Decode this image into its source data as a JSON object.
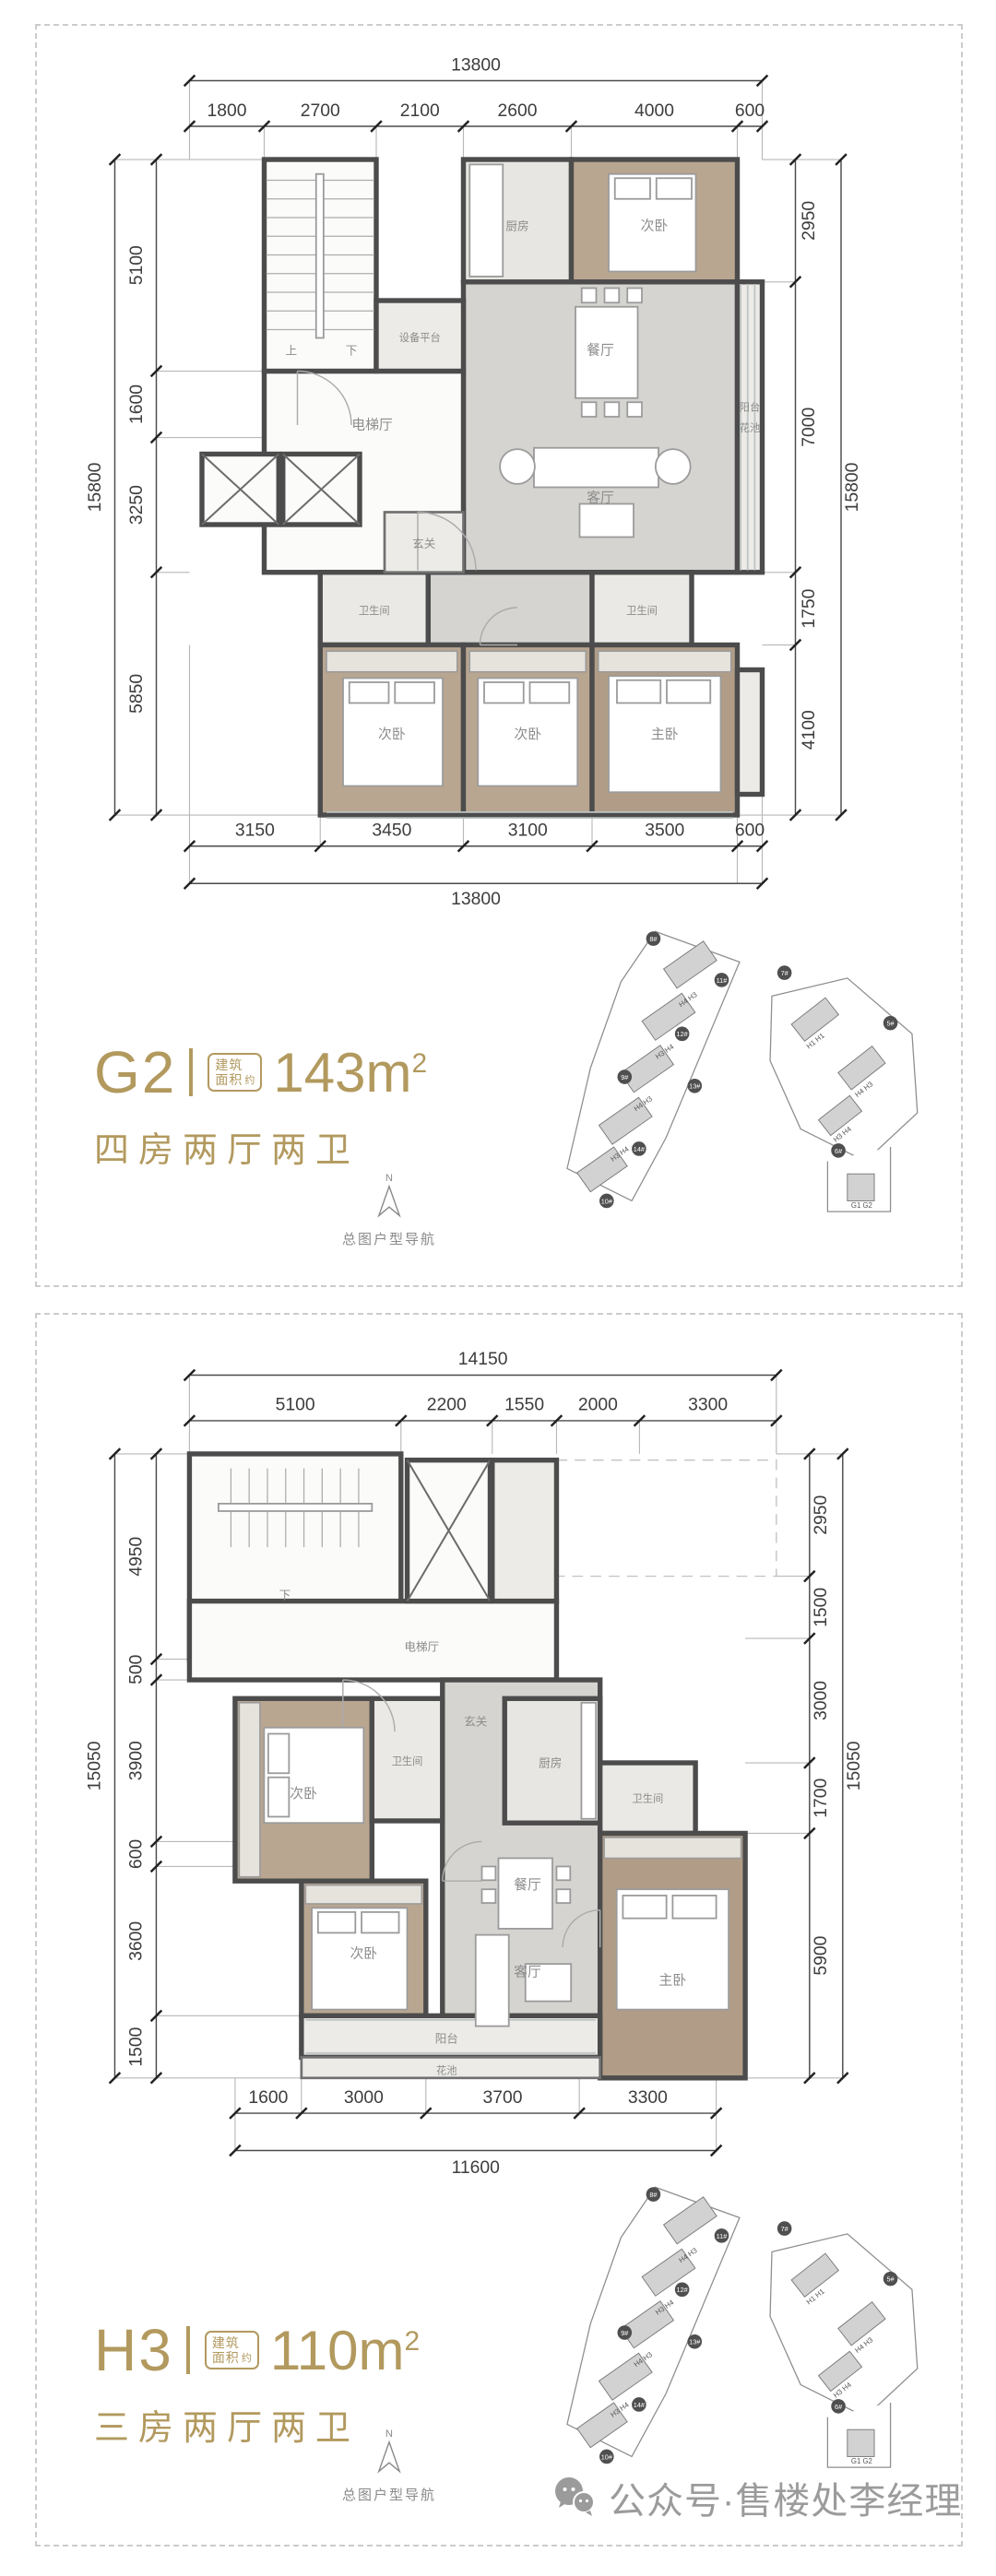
{
  "colors": {
    "gold": "#b2995e",
    "wall": "#4c4c4c",
    "wood": "#b9a691",
    "marble": "#d5d4d1",
    "watermark": "#9b9b9b"
  },
  "panels": [
    {
      "unit": {
        "code": "G2",
        "badge_line1": "建筑",
        "badge_line2": "面积",
        "badge_suffix": "约",
        "area": "143m",
        "area_sup": "2",
        "subtitle": "四房两厅两卫"
      },
      "plan": {
        "dims": {
          "top_total": "13800",
          "top_segments": [
            "1800",
            "2700",
            "2100",
            "2600",
            "4000",
            "600"
          ],
          "bottom_segments": [
            "3150",
            "3450",
            "3100",
            "3500",
            "600"
          ],
          "bottom_total": "13800",
          "left_segments": [
            "5100",
            "1600",
            "3250",
            "5850"
          ],
          "left_total": "15800",
          "right_segments": [
            "2950",
            "7000",
            "1750",
            "4100"
          ],
          "right_total": "15800"
        },
        "rooms": {
          "stair_up": "上",
          "stair_down": "下",
          "equipment": "设备平台",
          "kitchen": "厨房",
          "bedroom_top": "次卧",
          "dining": "餐厅",
          "living": "客厅",
          "balcony": "阳台",
          "flower_bed": "花池",
          "elevator_hall": "电梯厅",
          "foyer": "玄关",
          "bath_left": "卫生间",
          "bath_right": "卫生间",
          "bedroom_left": "次卧",
          "bedroom_mid": "次卧",
          "master": "主卧"
        }
      }
    },
    {
      "unit": {
        "code": "H3",
        "badge_line1": "建筑",
        "badge_line2": "面积",
        "badge_suffix": "约",
        "area": "110m",
        "area_sup": "2",
        "subtitle": "三房两厅两卫"
      },
      "plan": {
        "dims": {
          "top_total": "14150",
          "top_segments": [
            "5100",
            "2200",
            "1550",
            "2000",
            "3300"
          ],
          "bottom_segments": [
            "1600",
            "3000",
            "3700",
            "3300"
          ],
          "bottom_total": "11600",
          "left_segments": [
            "4950",
            "500",
            "3900",
            "600",
            "3600",
            "1500"
          ],
          "left_total": "15050",
          "right_segments": [
            "2950",
            "1500",
            "3000",
            "1700",
            "5900"
          ],
          "right_total": "15050"
        },
        "rooms": {
          "stair_down": "下",
          "elevator_hall": "电梯厅",
          "foyer": "玄关",
          "kitchen": "厨房",
          "bedroom_top": "次卧",
          "bath_left": "卫生间",
          "dining": "餐厅",
          "bath_right": "卫生间",
          "bedroom_mid": "次卧",
          "living": "客厅",
          "master": "主卧",
          "balcony": "阳台",
          "flower_bed": "花池"
        }
      }
    }
  ],
  "sitemap": {
    "nav_label": "总图户型导航",
    "compass_n": "N",
    "badges": [
      "8#",
      "11#",
      "7#",
      "12#",
      "9#",
      "13#",
      "5#",
      "14#",
      "10#",
      "6#"
    ],
    "units": [
      "H4 H3",
      "H3 H4",
      "H4 H3",
      "H3 H4",
      "H1 H1",
      "H4 H3",
      "H3 H4",
      "G1 G2"
    ]
  },
  "footer": {
    "text": "公众号·售楼处李经理",
    "icon": "wechat-icon"
  }
}
